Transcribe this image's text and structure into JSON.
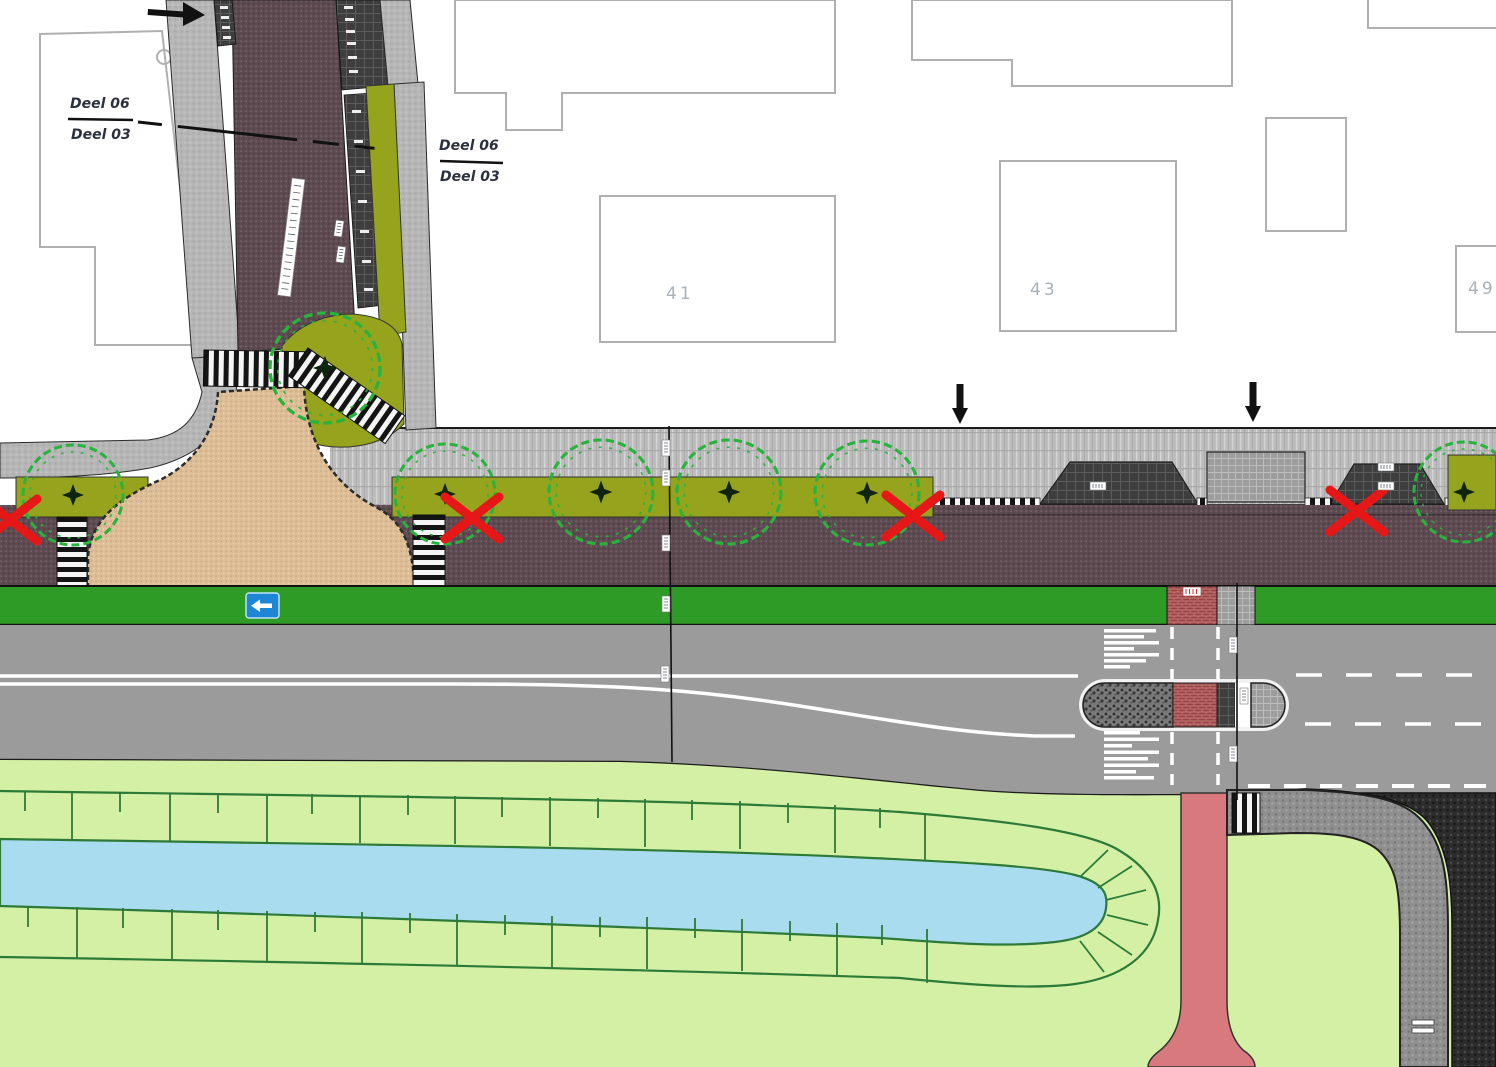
{
  "plan": {
    "section_markers": [
      {
        "top": "Deel 06",
        "bottom": "Deel 03"
      },
      {
        "top": "Deel 06",
        "bottom": "Deel 03"
      }
    ],
    "buildings": [
      {
        "number": "41"
      },
      {
        "number": "43"
      },
      {
        "number": "49"
      }
    ],
    "signs": {
      "one_way_sign_arrow": "left"
    },
    "marks": {
      "red_x_count": 4,
      "tree_count": 7,
      "down_arrow_count": 2,
      "right_arrow_count": 1
    },
    "colors": {
      "brick_street": "#5e4b52",
      "plateau": "#dcbd96",
      "planting_strip": "#96a31c",
      "verge_green": "#2f9b27",
      "grass": "#d3f0a4",
      "water": "#aadcf0",
      "foot_path_pink": "#d8797d",
      "road_gray": "#9b9b9b",
      "removal_mark_red": "#e61717",
      "tree_green": "#28b33c",
      "sign_blue": "#1f86d6"
    }
  }
}
